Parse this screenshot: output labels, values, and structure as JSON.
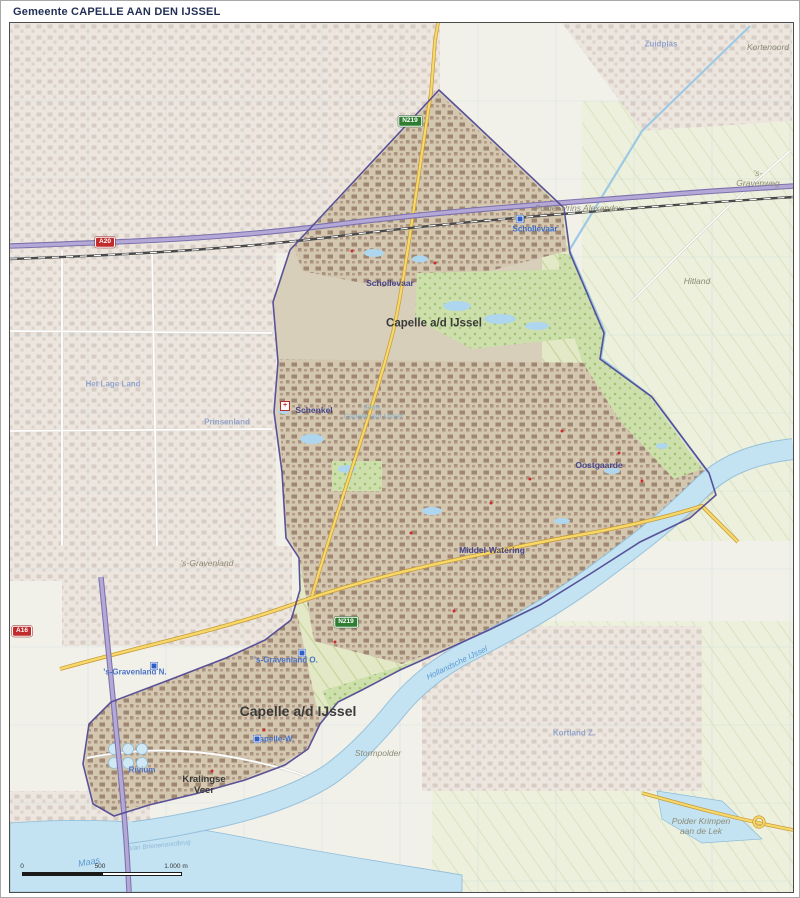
{
  "title": "Gemeente CAPELLE AAN DEN IJSSEL",
  "labels": {
    "capelle_center": "Capelle a/d IJssel",
    "capelle_south": "Capelle a/d IJssel",
    "schollevaar_station": "Schollevaar",
    "schollevaar": "Schollevaar",
    "schenkel": "Schenkel",
    "oostgaarde": "Oostgaarde",
    "middel_watering": "Middel-Watering",
    "gem_capelle": "Gem.\nCapelle a/d IJssel",
    "gravenland": "'s-Gravenland",
    "gravenland_o": "'s-Gravenland O.",
    "gravenland_n": "'s-Gravenland N.",
    "capelle_w": "Capelle-W.",
    "kralingse_veer": "Kralingse\nVeer",
    "rivium": "Rivium",
    "stormpolder": "Stormpolder",
    "kortland_z": "Kortland Z.",
    "polder_prins_alexander": "Polder Prins Alexander",
    "hitland": "Hitland",
    "gravenweg": "'s-Gravenweg",
    "kortenoord": "Kortenoord",
    "zuidplas": "Zuidplas",
    "het_lage_land": "Het Lage Land",
    "prinsenland": "Prinsenland",
    "polder_krimpen": "Polder Krimpen\naan de Lek",
    "maas": "Maas",
    "hollandsche_ijssel": "Hollandsche IJssel",
    "van_brienenoordbrug": "Van Brienenoordbrug"
  },
  "shields": {
    "a20": "A20",
    "a16": "A16",
    "n219_north": "N219",
    "n219_south": "N219"
  },
  "scalebar": {
    "zero": "0",
    "mid": "500",
    "end": "1.000 m"
  },
  "colors": {
    "paper": "#f1f0e9",
    "water": "#c3e2f2",
    "municipality_boundary": "#524a94",
    "motorway": "#b3a8d6",
    "main_road": "#f7d969",
    "urban_saturated": "#9f8672",
    "urban_faded": "#d8cdc5",
    "park": "#cde0ab",
    "title_text": "#223055"
  }
}
